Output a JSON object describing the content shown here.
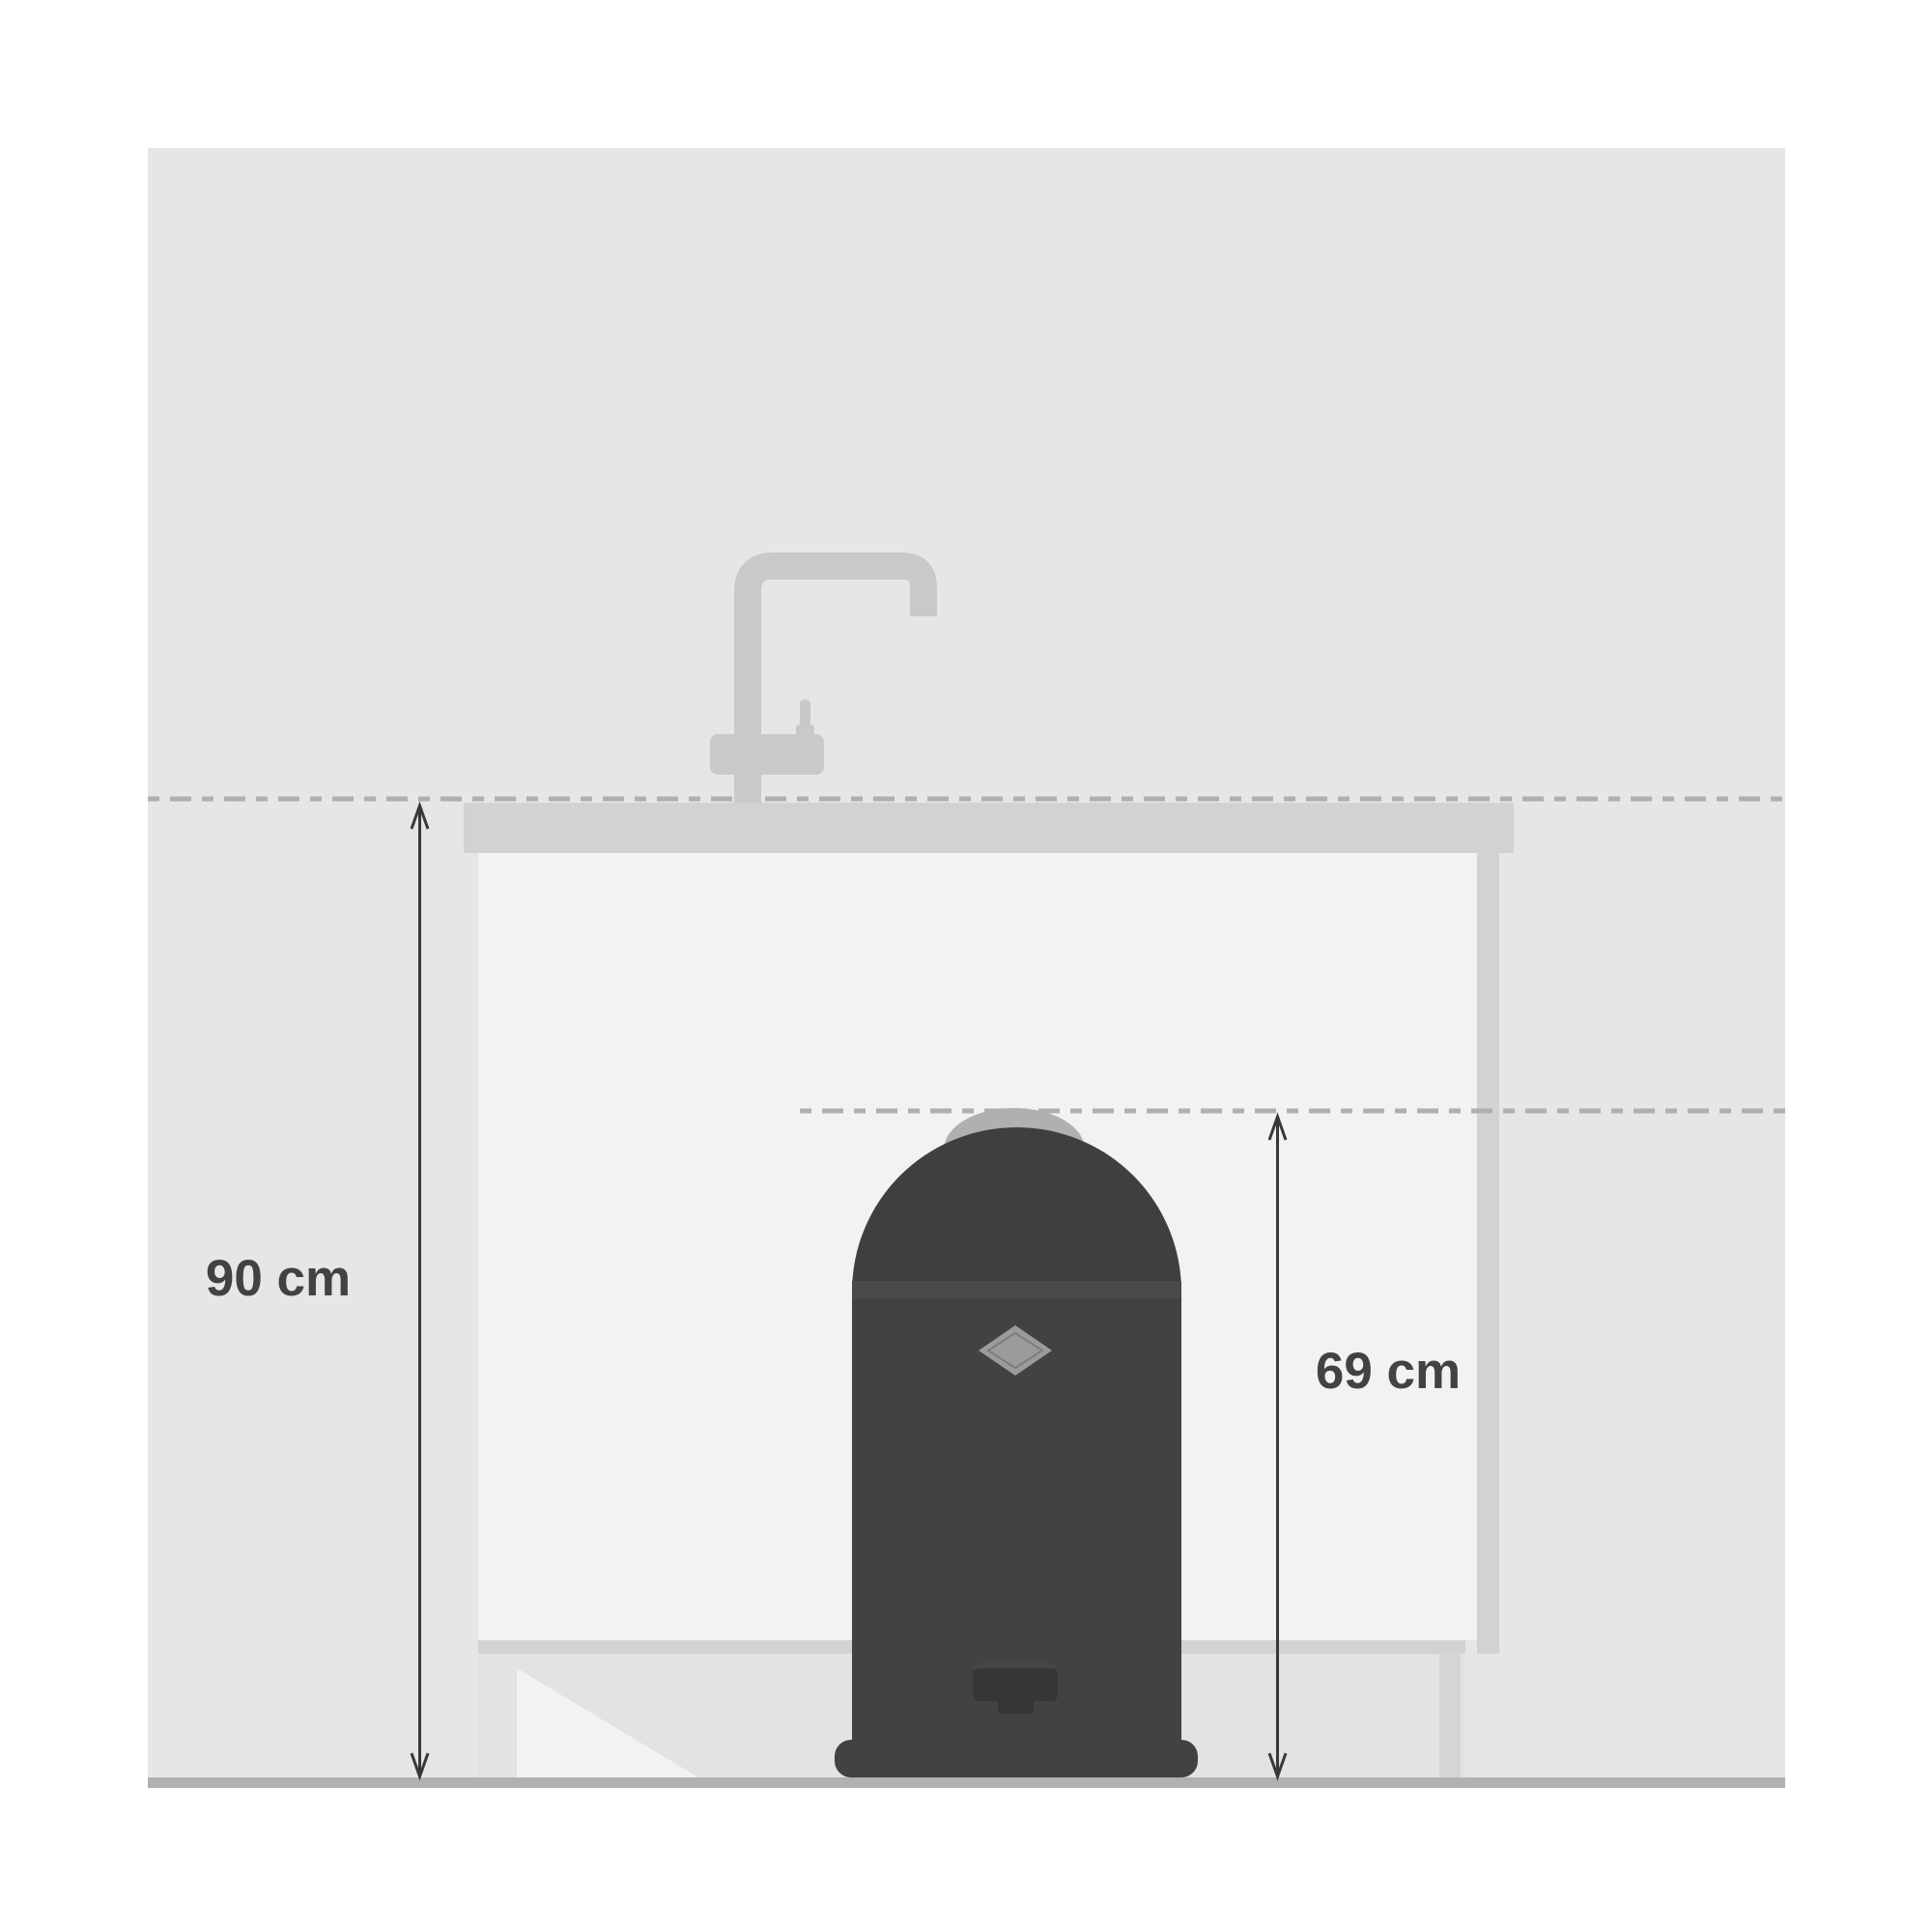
{
  "diagram": {
    "type": "kitchen-dimension-illustration",
    "labels": {
      "counter_height": "90 cm",
      "bin_height": "69 cm"
    },
    "objects": [
      "kitchen-wall",
      "kitchen-floor",
      "countertop",
      "base-cabinet",
      "kitchen-faucet",
      "pedal-waste-bin"
    ],
    "colors": {
      "background": "#ffffff",
      "wall": "#e6e6e6",
      "cabinet_front": "#f2f2f2",
      "counter": "#d2d2d2",
      "cabinet_edge": "#d5d5d5",
      "floor": "#b1b1b1",
      "faucet": "#c9c9c9",
      "dash_line": "#afafaf",
      "bin_lid": "#3f3f3f",
      "bin_seam": "#4a4a4a",
      "bin_body": "#424242",
      "bin_pedal": "#363636",
      "bin_lid_cap": "#b0b0b0",
      "bin_badge": "#9b9b9b",
      "dimension_arrow": "#383838",
      "dimension_text": "#424242"
    }
  }
}
